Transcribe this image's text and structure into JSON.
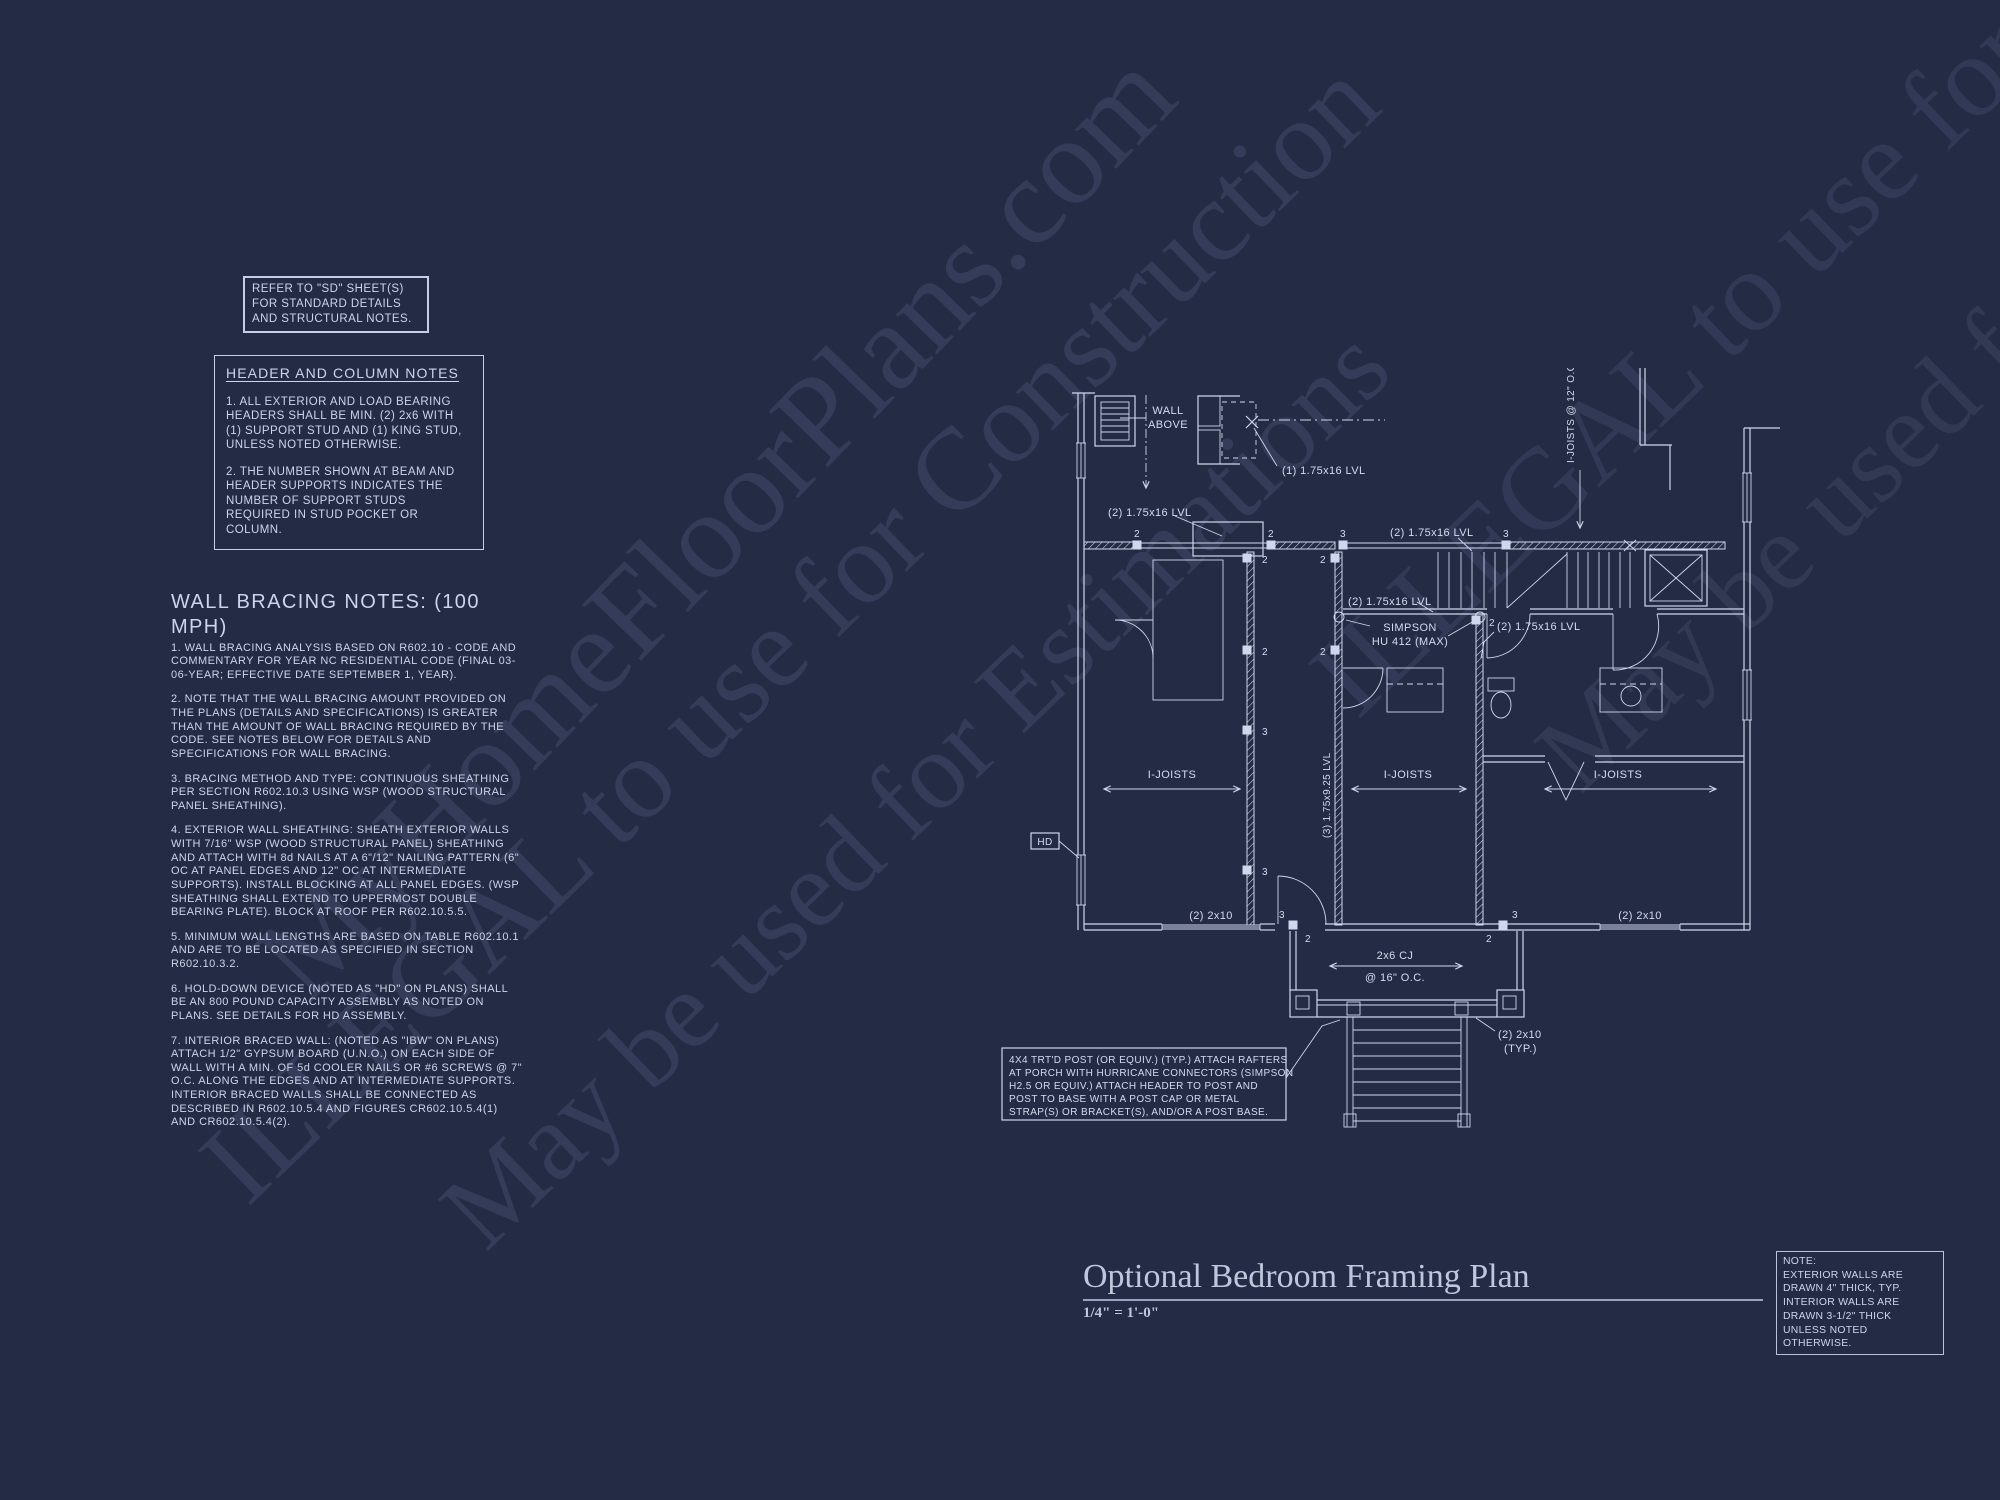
{
  "colors": {
    "background": "#242b44",
    "line": "#cfd7ec",
    "text": "#cdd5ea",
    "watermark": "#8b97c4"
  },
  "watermarks": {
    "brand": "MyHomeFloorPlans.com",
    "illegal": "ILLEGAL to use for Construction",
    "estimate": "May be used for Estimations"
  },
  "ref_note": {
    "lines": [
      "REFER TO \"SD\" SHEET(S)",
      "FOR STANDARD DETAILS",
      "AND STRUCTURAL NOTES."
    ]
  },
  "header_notes": {
    "title": "HEADER AND COLUMN NOTES",
    "items": [
      "1. ALL EXTERIOR AND LOAD BEARING HEADERS SHALL BE MIN. (2) 2x6 WITH (1) SUPPORT STUD AND (1) KING STUD, UNLESS NOTED OTHERWISE.",
      "2. THE NUMBER SHOWN AT BEAM AND HEADER SUPPORTS INDICATES THE NUMBER OF SUPPORT STUDS REQUIRED IN STUD POCKET OR COLUMN."
    ]
  },
  "wall_bracing": {
    "title": "WALL BRACING NOTES: (100 MPH)",
    "items": [
      "1. WALL BRACING ANALYSIS BASED ON R602.10 - CODE AND COMMENTARY FOR YEAR NC RESIDENTIAL CODE (FINAL 03-06-YEAR; EFFECTIVE DATE SEPTEMBER 1, YEAR).",
      "2. NOTE THAT THE WALL BRACING AMOUNT PROVIDED ON THE PLANS (DETAILS AND SPECIFICATIONS) IS GREATER THAN THE AMOUNT OF WALL BRACING REQUIRED BY THE CODE. SEE NOTES BELOW FOR DETAILS AND SPECIFICATIONS FOR WALL BRACING.",
      "3. BRACING METHOD AND TYPE: CONTINUOUS SHEATHING PER SECTION R602.10.3 USING WSP (WOOD STRUCTURAL PANEL SHEATHING).",
      "4. EXTERIOR WALL SHEATHING: SHEATH EXTERIOR WALLS WITH 7/16\" WSP (WOOD STRUCTURAL PANEL) SHEATHING AND ATTACH WITH 8d NAILS AT A 6\"/12\" NAILING PATTERN (6\" OC AT PANEL EDGES AND 12\" OC AT INTERMEDIATE SUPPORTS). INSTALL BLOCKING AT ALL PANEL EDGES. (WSP SHEATHING SHALL EXTEND TO UPPERMOST DOUBLE BEARING PLATE). BLOCK AT ROOF PER R602.10.5.5.",
      "5. MINIMUM WALL LENGTHS ARE BASED ON TABLE R602.10.1 AND ARE TO BE LOCATED AS SPECIFIED IN SECTION R602.10.3.2.",
      "6. HOLD-DOWN DEVICE (NOTED AS \"HD\" ON PLANS) SHALL BE AN 800 POUND CAPACITY ASSEMBLY AS NOTED ON PLANS. SEE DETAILS FOR HD ASSEMBLY.",
      "7. INTERIOR BRACED WALL: (NOTED AS \"IBW\" ON PLANS) ATTACH 1/2\" GYPSUM BOARD (U.N.O.) ON EACH SIDE OF WALL WITH A MIN. OF 5d COOLER NAILS OR #6 SCREWS @ 7\" O.C. ALONG THE EDGES AND AT INTERMEDIATE SUPPORTS.  INTERIOR BRACED WALLS SHALL BE CONNECTED AS DESCRIBED IN R602.10.5.4 AND FIGURES CR602.10.5.4(1) AND CR602.10.5.4(2)."
    ]
  },
  "plan": {
    "wall_above_line1": "WALL",
    "wall_above_line2": "ABOVE",
    "lvl_1x16": "(1) 1.75x16 LVL",
    "lvl_2x16": "(2) 1.75x16 LVL",
    "lvl_3x925": "(3) 1.75x9.25 LVL",
    "simpson_line1": "SIMPSON",
    "simpson_line2": "HU 412 (MAX)",
    "i_joists": "I-JOISTS",
    "i_joists_vertical": "I-JOISTS @ 12\" O.C.",
    "hd_label": "HD",
    "header_2x10": "(2) 2x10",
    "cj_line1": "2x6 CJ",
    "cj_line2": "@ 16\" O.C.",
    "typ_line1": "(2) 2x10",
    "typ_line2": "(TYP.)",
    "s2": "2",
    "s3": "3",
    "post_note_lines": [
      "4X4 TRT'D POST (OR EQUIV.) (TYP.) ATTACH RAFTERS",
      "AT PORCH WITH HURRICANE CONNECTORS (SIMPSON",
      "H2.5 OR EQUIV.) ATTACH HEADER TO POST AND",
      "POST TO BASE WITH A POST CAP OR METAL",
      "STRAP(S) OR BRACKET(S), AND/OR A POST BASE."
    ]
  },
  "title_block": {
    "title": "Optional Bedroom Framing Plan",
    "scale": "1/4\" = 1'-0\""
  },
  "corner_note": {
    "lines": [
      "NOTE:",
      "EXTERIOR WALLS ARE",
      "DRAWN 4\" THICK, TYP.",
      "INTERIOR WALLS ARE",
      "DRAWN 3-1/2\" THICK",
      "UNLESS NOTED OTHERWISE."
    ]
  }
}
